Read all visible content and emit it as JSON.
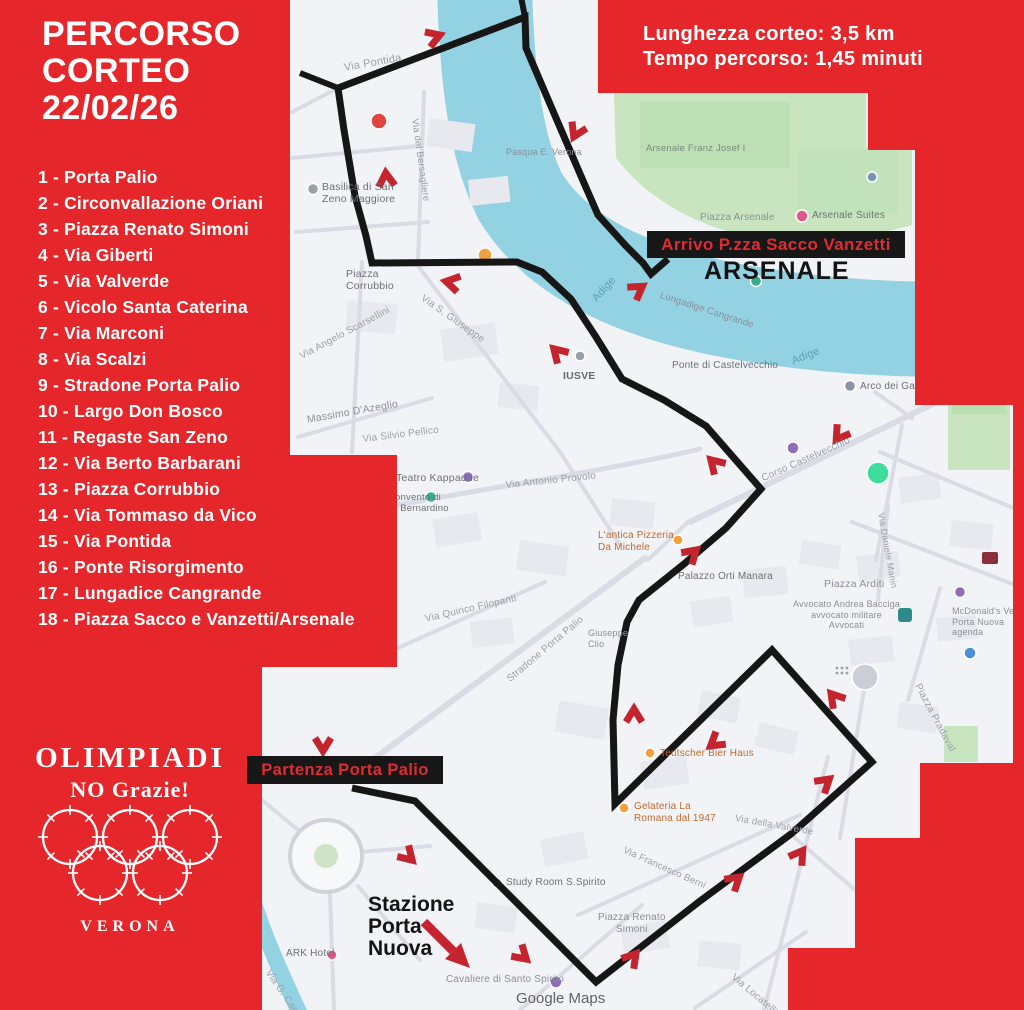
{
  "poster": {
    "title": [
      "PERCORSO",
      "CORTEO",
      "22/02/26"
    ],
    "info": [
      "Lunghezza corteo: 3,5 km",
      "Tempo percorso: 1,45 minuti"
    ],
    "route_list": [
      "1 - Porta Palio",
      "2 - Circonvallazione Oriani",
      "3 - Piazza Renato Simoni",
      "4 - Via Giberti",
      "5 - Via Valverde",
      "6 - Vicolo Santa Caterina",
      "7 - Via Marconi",
      "8 - Via Scalzi",
      "9 - Stradone Porta Palio",
      "10 - Largo Don Bosco",
      "11 - Regaste San Zeno",
      "12 - Via Berto Barbarani",
      "13 - Piazza Corrubbio",
      "14 - Via Tommaso da Vico",
      "15 - Via Pontida",
      "16 - Ponte Risorgimento",
      "17 - Lungadice Cangrande",
      "18 - Piazza Sacco e Vanzetti/Arsenale"
    ],
    "logo": {
      "title": "OLIMPIADI",
      "subtitle": "NO Grazie!",
      "city": "VERONA"
    },
    "colors": {
      "poster_red": "#e5262b",
      "callout_text_red": "#e02b31",
      "route_black": "#161616",
      "arrow_red": "#c4242d",
      "river_blue": "#93d2e2",
      "park_green": "#c8e5c0"
    }
  },
  "map": {
    "callouts": {
      "arrivo": "Arrivo P.zza Sacco Vanzetti",
      "arsenale": "ARSENALE",
      "partenza": "Partenza Porta Palio",
      "stazione": "Stazione\nPorta\nNuova",
      "watermark": "Google Maps"
    },
    "route": {
      "points": [
        [
          352,
          788
        ],
        [
          415,
          801
        ],
        [
          596,
          982
        ],
        [
          700,
          901
        ],
        [
          791,
          834
        ],
        [
          872,
          762
        ],
        [
          772,
          650
        ],
        [
          615,
          804
        ],
        [
          613,
          720
        ],
        [
          618,
          665
        ],
        [
          627,
          622
        ],
        [
          639,
          600
        ],
        [
          684,
          564
        ],
        [
          726,
          528
        ],
        [
          761,
          489
        ],
        [
          706,
          426
        ],
        [
          664,
          400
        ],
        [
          622,
          379
        ],
        [
          596,
          337
        ],
        [
          571,
          299
        ],
        [
          542,
          272
        ],
        [
          517,
          262
        ],
        [
          372,
          263
        ],
        [
          366,
          236
        ],
        [
          355,
          196
        ],
        [
          344,
          130
        ],
        [
          338,
          88
        ],
        [
          525,
          17
        ],
        [
          526,
          48
        ],
        [
          556,
          118
        ],
        [
          584,
          183
        ],
        [
          598,
          215
        ],
        [
          626,
          246
        ],
        [
          643,
          263
        ],
        [
          651,
          274
        ],
        [
          668,
          259
        ]
      ],
      "spur": [
        [
          338,
          88
        ],
        [
          300,
          73
        ]
      ],
      "spur2": [
        [
          525,
          17
        ],
        [
          520,
          -8
        ]
      ]
    },
    "arrows": [
      {
        "x": 323,
        "y": 748,
        "r": 90
      },
      {
        "x": 410,
        "y": 858,
        "r": 45
      },
      {
        "x": 524,
        "y": 957,
        "r": 42
      },
      {
        "x": 634,
        "y": 956,
        "r": -50
      },
      {
        "x": 737,
        "y": 879,
        "r": -40
      },
      {
        "x": 801,
        "y": 853,
        "r": -55
      },
      {
        "x": 827,
        "y": 781,
        "r": -40
      },
      {
        "x": 833,
        "y": 696,
        "r": -130
      },
      {
        "x": 713,
        "y": 744,
        "r": 142
      },
      {
        "x": 634,
        "y": 712,
        "r": -90
      },
      {
        "x": 694,
        "y": 552,
        "r": -42
      },
      {
        "x": 713,
        "y": 462,
        "r": -135
      },
      {
        "x": 838,
        "y": 437,
        "r": 125
      },
      {
        "x": 556,
        "y": 351,
        "r": -135
      },
      {
        "x": 449,
        "y": 282,
        "r": -168
      },
      {
        "x": 386,
        "y": 176,
        "r": -95
      },
      {
        "x": 437,
        "y": 36,
        "r": -20
      },
      {
        "x": 575,
        "y": 134,
        "r": 115
      },
      {
        "x": 640,
        "y": 288,
        "r": -35
      }
    ],
    "pois": [
      {
        "id": "marker-red-ring",
        "x": 379,
        "y": 121,
        "r": 8,
        "c": "#e0453e"
      },
      {
        "id": "poi-orange",
        "x": 485,
        "y": 255,
        "r": 7,
        "c": "#f0a03c"
      },
      {
        "id": "poi-gray",
        "x": 313,
        "y": 189,
        "r": 5.5,
        "c": "#9aa0a8"
      },
      {
        "id": "poi-purple",
        "x": 468,
        "y": 477,
        "r": 5.5,
        "c": "#8e6db8"
      },
      {
        "id": "poi-teal",
        "x": 431,
        "y": 497,
        "r": 5.5,
        "c": "#3aa98e"
      },
      {
        "id": "poi-gray",
        "x": 580,
        "y": 356,
        "r": 5,
        "c": "#9aa0a8"
      },
      {
        "id": "poi-purple",
        "x": 793,
        "y": 448,
        "r": 6,
        "c": "#8e6db8"
      },
      {
        "id": "poi-green",
        "x": 756,
        "y": 281,
        "r": 5.5,
        "c": "#3aa98e"
      },
      {
        "id": "poi-pink",
        "x": 802,
        "y": 216,
        "r": 6,
        "c": "#e2578c"
      },
      {
        "id": "poi-blue",
        "x": 872,
        "y": 177,
        "r": 5,
        "c": "#7a93b5"
      },
      {
        "id": "poi-green-large",
        "x": 878,
        "y": 473,
        "r": 11,
        "c": "#3fdc9b"
      },
      {
        "id": "poi-purple",
        "x": 960,
        "y": 592,
        "r": 5.5,
        "c": "#8e6db8"
      },
      {
        "id": "poi-blue",
        "x": 970,
        "y": 653,
        "r": 6,
        "c": "#4a90d9"
      },
      {
        "id": "poi-gray-large",
        "x": 865,
        "y": 677,
        "r": 13,
        "c": "#caced6"
      },
      {
        "id": "poi-purple",
        "x": 556,
        "y": 982,
        "r": 6,
        "c": "#8e6db8"
      },
      {
        "id": "poi-gray",
        "x": 497,
        "y": 883,
        "r": 5,
        "c": "#9aa0a8"
      },
      {
        "id": "poi-orange",
        "x": 678,
        "y": 540,
        "r": 5,
        "c": "#f0a03c"
      },
      {
        "id": "poi-orange",
        "x": 650,
        "y": 753,
        "r": 5,
        "c": "#f0a03c"
      },
      {
        "id": "poi-orange",
        "x": 624,
        "y": 808,
        "r": 5,
        "c": "#f0a03c"
      },
      {
        "id": "poi-pink",
        "x": 332,
        "y": 955,
        "r": 5,
        "c": "#e2578c"
      },
      {
        "id": "poi-person",
        "x": 850,
        "y": 386,
        "r": 5.5,
        "c": "#8a93a3"
      }
    ],
    "labels": [
      {
        "id": "via-pontida",
        "t": "Via Pontida",
        "x": 343,
        "y": 62,
        "s": 11,
        "c": "#9aa0a8",
        "r": -10
      },
      {
        "id": "basilica-san-zeno",
        "t": "Basilica di San\nZeno Maggiore",
        "x": 322,
        "y": 181,
        "s": 10.5,
        "c": "#6b7078",
        "r": 0
      },
      {
        "id": "piazza-corrubbio",
        "t": "Piazza\nCorrubbio",
        "x": 346,
        "y": 268,
        "s": 10.5,
        "c": "#6b7078",
        "r": 0
      },
      {
        "id": "via-angelo-scarsellini",
        "t": "Via Angelo Scarsellini",
        "x": 298,
        "y": 352,
        "s": 10,
        "c": "#9aa0a8",
        "r": -28
      },
      {
        "id": "massimo-dazeglio",
        "t": "Massimo D'Azeglio",
        "x": 306,
        "y": 414,
        "s": 10.5,
        "c": "#8a8f98",
        "r": -10
      },
      {
        "id": "via-silvio-pellico",
        "t": "Via Silvio Pellico",
        "x": 362,
        "y": 434,
        "s": 10,
        "c": "#9aa0a8",
        "r": -7
      },
      {
        "id": "teatro-kappadue",
        "t": "Teatro Kappadue",
        "x": 396,
        "y": 472,
        "s": 10.5,
        "c": "#6b7078",
        "r": 0
      },
      {
        "id": "convento",
        "t": "Convento di\nS. Bernardino",
        "x": 388,
        "y": 492,
        "s": 9.5,
        "c": "#6b7078",
        "r": 0
      },
      {
        "id": "via-antonio-provolo",
        "t": "Via Antonio Provolo",
        "x": 505,
        "y": 480,
        "s": 10,
        "c": "#9aa0a8",
        "r": -6
      },
      {
        "id": "via-quirico-filopanti",
        "t": "Via Quirico Filopanti",
        "x": 424,
        "y": 614,
        "s": 10,
        "c": "#9aa0a8",
        "r": -13
      },
      {
        "id": "stradone-porta-palio",
        "t": "Stradone Porta Palio",
        "x": 505,
        "y": 676,
        "s": 10,
        "c": "#9aa0a8",
        "r": -40
      },
      {
        "id": "via-del-bersagliere",
        "t": "Via del Bersagliere",
        "x": 420,
        "y": 118,
        "s": 9.5,
        "c": "#9aa0a8",
        "r": 82
      },
      {
        "id": "via-s-giuseppe",
        "t": "Via S. Giuseppe",
        "x": 425,
        "y": 293,
        "s": 10,
        "c": "#9aa0a8",
        "r": 35
      },
      {
        "id": "iusve",
        "t": "IUSVE",
        "x": 563,
        "y": 370,
        "s": 10.5,
        "c": "#666b73",
        "r": 0,
        "w": 700
      },
      {
        "id": "adige-1",
        "t": "Adige",
        "x": 590,
        "y": 296,
        "s": 11,
        "c": "#5d9fb5",
        "r": -48
      },
      {
        "id": "adige-2",
        "t": "Adige",
        "x": 790,
        "y": 356,
        "s": 11,
        "c": "#5d9fb5",
        "r": -22
      },
      {
        "id": "lungadige-cangrande",
        "t": "Lungadige Cangrande",
        "x": 662,
        "y": 290,
        "s": 9.5,
        "c": "#8a8f98",
        "r": 18
      },
      {
        "id": "ponte-castelvecchio",
        "t": "Ponte di Castelvecchio",
        "x": 672,
        "y": 360,
        "s": 10,
        "c": "#6b7078",
        "r": 0
      },
      {
        "id": "arco-dei-gavi",
        "t": "Arco dei Gavi",
        "x": 860,
        "y": 381,
        "s": 10,
        "c": "#6b7078",
        "r": 0
      },
      {
        "id": "corso-castelvecchio",
        "t": "Corso Castelvecchio",
        "x": 760,
        "y": 474,
        "s": 10,
        "c": "#9aa0a8",
        "r": -24
      },
      {
        "id": "piazza-arsenale",
        "t": "Piazza Arsenale",
        "x": 700,
        "y": 212,
        "s": 10,
        "c": "#8a8f98",
        "r": 0
      },
      {
        "id": "arsenale-suites",
        "t": "Arsenale Suites",
        "x": 812,
        "y": 210,
        "s": 10,
        "c": "#6b7078",
        "r": 0
      },
      {
        "id": "arsenale-franz",
        "t": "Arsenale Franz Josef I",
        "x": 646,
        "y": 143,
        "s": 9.5,
        "c": "#7a8a7a",
        "r": 0
      },
      {
        "id": "pasqua",
        "t": "Pasqua E. Verona",
        "x": 506,
        "y": 147,
        "s": 9,
        "c": "#8a8f98",
        "r": 0
      },
      {
        "id": "antica-pizzeria",
        "t": "L'antica Pizzeria\nDa Michele",
        "x": 598,
        "y": 530,
        "s": 10,
        "c": "#c06a2e",
        "r": 0
      },
      {
        "id": "palazzo-orti-manara",
        "t": "Palazzo Orti Manara",
        "x": 678,
        "y": 571,
        "s": 10,
        "c": "#6b7078",
        "r": 0
      },
      {
        "id": "piazza-arditi",
        "t": "Piazza Arditi",
        "x": 824,
        "y": 578,
        "s": 10.5,
        "c": "#8a8f98",
        "r": 0
      },
      {
        "id": "avvocato",
        "t": "Avvocato Andrea Bacciga\navvocato militare\nAvvocati",
        "x": 793,
        "y": 599,
        "s": 9,
        "c": "#8a8f98",
        "r": 0,
        "a": "center"
      },
      {
        "id": "mcdonalds",
        "t": "McDonald's Verona\nPorta Nuova\nagenda",
        "x": 952,
        "y": 606,
        "s": 9,
        "c": "#8a8f98",
        "r": 0
      },
      {
        "id": "gelateria",
        "t": "Gelateria La\nRomana dal 1947",
        "x": 634,
        "y": 801,
        "s": 10,
        "c": "#c06a2e",
        "r": 0
      },
      {
        "id": "bier-haus",
        "t": "Teutscher Bier Haus",
        "x": 660,
        "y": 748,
        "s": 10,
        "c": "#c06a2e",
        "r": 0
      },
      {
        "id": "via-della-valverde",
        "t": "Via della Valverde",
        "x": 736,
        "y": 813,
        "s": 9.5,
        "c": "#9aa0a8",
        "r": 10
      },
      {
        "id": "via-francesco-berni",
        "t": "Via Francesco Berni",
        "x": 626,
        "y": 845,
        "s": 9.5,
        "c": "#9aa0a8",
        "r": 24
      },
      {
        "id": "piazza-renato-simoni",
        "t": "Piazza Renato\nSimoni",
        "x": 598,
        "y": 912,
        "s": 10,
        "c": "#8a8f98",
        "r": 0,
        "a": "center"
      },
      {
        "id": "study-room",
        "t": "Study Room S.Spirito",
        "x": 506,
        "y": 877,
        "s": 10,
        "c": "#6b7078",
        "r": 0
      },
      {
        "id": "cavaliere",
        "t": "Cavaliere di Santo Spirito",
        "x": 446,
        "y": 974,
        "s": 10,
        "c": "#8a8f98",
        "r": 0
      },
      {
        "id": "via-locatelli",
        "t": "Via Locatelli",
        "x": 736,
        "y": 972,
        "s": 10,
        "c": "#9aa0a8",
        "r": 40
      },
      {
        "id": "piazza-pradaval",
        "t": "Piazza Pradaval",
        "x": 922,
        "y": 682,
        "s": 10,
        "c": "#9aa0a8",
        "r": 62
      },
      {
        "id": "via-daniele-manin",
        "t": "Via Daniele Manin",
        "x": 886,
        "y": 512,
        "s": 9,
        "c": "#9aa0a8",
        "r": 80
      },
      {
        "id": "via-camuzzoni",
        "t": "Via G. Camuzzoni",
        "x": 272,
        "y": 968,
        "s": 10,
        "c": "#9aa0a8",
        "r": 55
      },
      {
        "id": "ark-hotel",
        "t": "ARK Hotel",
        "x": 286,
        "y": 948,
        "s": 10,
        "c": "#6b7078",
        "r": 0
      },
      {
        "id": "giuseppe-clio",
        "t": "Giuseppe\nClio",
        "x": 588,
        "y": 628,
        "s": 9,
        "c": "#8a8f98",
        "r": 0
      }
    ]
  }
}
